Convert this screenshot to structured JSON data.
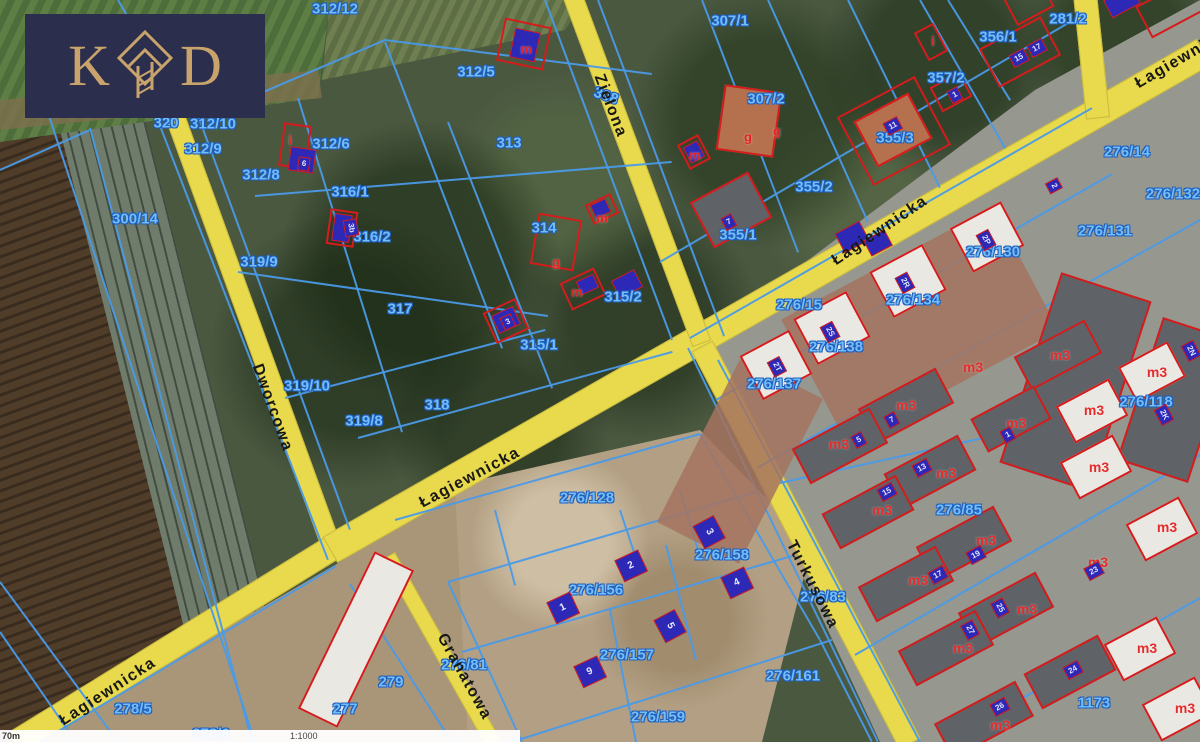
{
  "brand": {
    "letter_left": "K",
    "letter_right": "D",
    "icon": "diamond-house-icon",
    "background_color": "#2b2e4c",
    "gold_color": "#c9a36c"
  },
  "scale_bar": {
    "distance_label": "70m",
    "scale_label": "1:1000"
  },
  "map": {
    "colors": {
      "road_yellow": "#e9d94d",
      "parcel_line_blue": "#4a9ae8",
      "parcel_label_blue": "#74bdf6",
      "building_red": "#d41c1c",
      "building_blue_fill": "#2d28b5"
    },
    "roads": [
      {
        "name": "dworcowa",
        "x1": 172,
        "y1": 108,
        "x2": 332,
        "y2": 548,
        "w": 20
      },
      {
        "name": "lagiewnicka-west",
        "x1": 332,
        "y1": 548,
        "x2": 14,
        "y2": 744,
        "w": 26
      },
      {
        "name": "lagiewnicka-main",
        "x1": 330,
        "y1": 550,
        "x2": 1204,
        "y2": 52,
        "w": 30
      },
      {
        "name": "top-right-stub",
        "x1": 1085,
        "y1": -6,
        "x2": 1098,
        "y2": 118,
        "w": 24
      },
      {
        "name": "zielona",
        "x1": 572,
        "y1": -6,
        "x2": 702,
        "y2": 344,
        "w": 20
      },
      {
        "name": "turkusowa",
        "x1": 702,
        "y1": 346,
        "x2": 910,
        "y2": 744,
        "w": 24
      },
      {
        "name": "granatowa",
        "x1": 388,
        "y1": 556,
        "x2": 494,
        "y2": 744,
        "w": 16
      }
    ],
    "road_labels": [
      [
        "Dworcowa",
        272,
        408,
        70
      ],
      [
        "Łagiewnicka",
        108,
        692,
        -33
      ],
      [
        "Łagiewnicka",
        470,
        478,
        -28
      ],
      [
        "Łagiewnicka",
        880,
        231,
        -34
      ],
      [
        "Łagiewnicka",
        1185,
        57,
        -30
      ],
      [
        "Zielona",
        610,
        106,
        69
      ],
      [
        "Turkusowa",
        812,
        585,
        63
      ],
      [
        "Granatowa",
        464,
        677,
        61
      ]
    ],
    "parcel_labels": [
      [
        "320",
        166,
        123
      ],
      [
        "312/10",
        213,
        124
      ],
      [
        "312/12",
        335,
        9
      ],
      [
        "312/9",
        203,
        149
      ],
      [
        "312/8",
        261,
        175
      ],
      [
        "312/6",
        331,
        144
      ],
      [
        "312/5",
        476,
        72
      ],
      [
        "313",
        509,
        143
      ],
      [
        "307/1",
        730,
        21
      ],
      [
        "307/2",
        766,
        99
      ],
      [
        "281/2",
        1068,
        19
      ],
      [
        "356/1",
        998,
        37
      ],
      [
        "357/2",
        946,
        78
      ],
      [
        "355/3",
        895,
        138
      ],
      [
        "355/2",
        814,
        187
      ],
      [
        "355/1",
        738,
        235
      ],
      [
        "314",
        544,
        228
      ],
      [
        "315/2",
        623,
        297
      ],
      [
        "315/1",
        539,
        345
      ],
      [
        "316/1",
        350,
        192
      ],
      [
        "316/2",
        372,
        237
      ],
      [
        "317",
        400,
        309
      ],
      [
        "318",
        437,
        405
      ],
      [
        "319/9",
        259,
        262
      ],
      [
        "319/10",
        307,
        386
      ],
      [
        "319/8",
        364,
        421
      ],
      [
        "300/14",
        135,
        219
      ],
      [
        "308",
        606,
        96,
        20
      ],
      [
        "276/14",
        1127,
        152
      ],
      [
        "276/132",
        1173,
        194
      ],
      [
        "276/131",
        1105,
        231
      ],
      [
        "276/130",
        993,
        252
      ],
      [
        "276/134",
        913,
        300
      ],
      [
        "276/15",
        799,
        305
      ],
      [
        "276/138",
        836,
        347
      ],
      [
        "276/137",
        774,
        384
      ],
      [
        "276/118",
        1146,
        402
      ],
      [
        "276/85",
        959,
        510
      ],
      [
        "276/128",
        587,
        498
      ],
      [
        "276/156",
        596,
        590
      ],
      [
        "276/158",
        722,
        555
      ],
      [
        "276/157",
        627,
        655
      ],
      [
        "276/159",
        658,
        717
      ],
      [
        "276/161",
        793,
        676
      ],
      [
        "276/83",
        823,
        597
      ],
      [
        "276/81",
        464,
        665
      ],
      [
        "279",
        391,
        682
      ],
      [
        "277",
        345,
        709
      ],
      [
        "278/5",
        133,
        709
      ],
      [
        "278/6",
        211,
        734
      ],
      [
        "1173",
        1094,
        703
      ]
    ],
    "red_labels": [
      [
        "m",
        526,
        49
      ],
      [
        "m",
        695,
        155
      ],
      [
        "g",
        748,
        137
      ],
      [
        "g",
        777,
        131
      ],
      [
        "i",
        933,
        41
      ],
      [
        "i",
        290,
        140
      ],
      [
        "g",
        556,
        262
      ],
      [
        "m",
        602,
        218
      ],
      [
        "m",
        577,
        292
      ]
    ],
    "m3_labels": [
      [
        "m3",
        1060,
        355
      ],
      [
        "m3",
        973,
        367
      ],
      [
        "m3",
        906,
        405
      ],
      [
        "m3",
        839,
        444
      ],
      [
        "m3",
        1094,
        410
      ],
      [
        "m3",
        1157,
        372
      ],
      [
        "m3",
        1016,
        423
      ],
      [
        "m3",
        946,
        473
      ],
      [
        "m3",
        882,
        510
      ],
      [
        "m3",
        1099,
        467
      ],
      [
        "m3",
        1167,
        527
      ],
      [
        "m3",
        986,
        540
      ],
      [
        "m3",
        1098,
        562
      ],
      [
        "m3",
        918,
        580
      ],
      [
        "m3",
        1027,
        609
      ],
      [
        "m3",
        963,
        648
      ],
      [
        "m3",
        1147,
        648
      ],
      [
        "m3",
        1000,
        725
      ],
      [
        "m3",
        1185,
        708
      ]
    ],
    "chips": [
      [
        "6",
        304,
        164,
        8
      ],
      [
        "3b",
        351,
        228,
        80
      ],
      [
        "11",
        893,
        126,
        -28
      ],
      [
        "15",
        1019,
        58,
        -28
      ],
      [
        "17",
        1037,
        48,
        -28
      ],
      [
        "1",
        955,
        95,
        -28
      ],
      [
        "7",
        729,
        222,
        -28
      ],
      [
        "2",
        1054,
        186,
        62
      ],
      [
        "2P",
        986,
        240,
        62
      ],
      [
        "2R",
        905,
        283,
        62
      ],
      [
        "2S",
        830,
        332,
        62
      ],
      [
        "2T",
        777,
        367,
        62
      ],
      [
        "3",
        508,
        322,
        -25
      ],
      [
        "7",
        892,
        420,
        -28
      ],
      [
        "5",
        859,
        440,
        -28
      ],
      [
        "13",
        922,
        468,
        -28
      ],
      [
        "15",
        887,
        492,
        -28
      ],
      [
        "1",
        1008,
        435,
        -28
      ],
      [
        "17",
        938,
        575,
        -28
      ],
      [
        "19",
        976,
        555,
        -28
      ],
      [
        "23",
        1094,
        571,
        -28
      ],
      [
        "25",
        1000,
        608,
        62
      ],
      [
        "27",
        970,
        630,
        62
      ],
      [
        "24",
        1073,
        670,
        -28
      ],
      [
        "26",
        1000,
        707,
        -28
      ],
      [
        "2N",
        1191,
        351,
        62
      ],
      [
        "2K",
        1164,
        415,
        62
      ]
    ],
    "big_chips": [
      [
        "1",
        563,
        608,
        -25
      ],
      [
        "2",
        631,
        566,
        -25
      ],
      [
        "3",
        709,
        532,
        62
      ],
      [
        "4",
        737,
        583,
        -25
      ],
      [
        "5",
        670,
        626,
        62
      ],
      [
        "9",
        590,
        672,
        -25
      ]
    ],
    "boundaries": [
      [
        28,
        52,
        255,
        742
      ],
      [
        90,
        128,
        252,
        742
      ],
      [
        0,
        170,
        90,
        130
      ],
      [
        118,
        0,
        180,
        106
      ],
      [
        0,
        582,
        118,
        742
      ],
      [
        0,
        632,
        76,
        742
      ],
      [
        150,
        100,
        328,
        560
      ],
      [
        196,
        110,
        350,
        530
      ],
      [
        240,
        102,
        385,
        40
      ],
      [
        385,
        40,
        652,
        74
      ],
      [
        255,
        196,
        672,
        162
      ],
      [
        238,
        272,
        548,
        316
      ],
      [
        285,
        398,
        545,
        330
      ],
      [
        358,
        438,
        672,
        352
      ],
      [
        385,
        42,
        502,
        348
      ],
      [
        448,
        122,
        552,
        388
      ],
      [
        298,
        98,
        402,
        432
      ],
      [
        545,
        0,
        672,
        340
      ],
      [
        598,
        0,
        724,
        336
      ],
      [
        702,
        0,
        798,
        252
      ],
      [
        768,
        0,
        868,
        222
      ],
      [
        848,
        0,
        940,
        188
      ],
      [
        920,
        0,
        1005,
        148
      ],
      [
        660,
        262,
        1070,
        22
      ],
      [
        690,
        338,
        1092,
        108
      ],
      [
        948,
        0,
        1010,
        100
      ],
      [
        716,
        400,
        1112,
        174
      ],
      [
        757,
        468,
        1200,
        220
      ],
      [
        780,
        483,
        1200,
        390
      ],
      [
        855,
        655,
        1200,
        455
      ],
      [
        945,
        742,
        1200,
        598
      ],
      [
        718,
        360,
        920,
        742
      ],
      [
        688,
        348,
        878,
        742
      ],
      [
        395,
        520,
        700,
        434
      ],
      [
        448,
        582,
        756,
        492
      ],
      [
        462,
        652,
        792,
        556
      ],
      [
        512,
        742,
        832,
        640
      ],
      [
        448,
        582,
        522,
        742
      ],
      [
        495,
        510,
        515,
        585
      ],
      [
        610,
        610,
        636,
        742
      ],
      [
        666,
        545,
        696,
        660
      ],
      [
        620,
        510,
        638,
        564
      ],
      [
        680,
        490,
        698,
        550
      ],
      [
        700,
        434,
        820,
        640
      ],
      [
        820,
        640,
        872,
        742
      ],
      [
        336,
        566,
        40,
        742
      ],
      [
        350,
        584,
        452,
        742
      ]
    ],
    "buildings": [
      {
        "x": 694,
        "y": 368,
        "w": 92,
        "h": 185,
        "r": 27,
        "t": "brick"
      },
      {
        "x": 800,
        "y": 255,
        "w": 240,
        "h": 140,
        "r": -28,
        "t": "brick"
      },
      {
        "x": 334,
        "y": 552,
        "w": 44,
        "h": 175,
        "r": 26,
        "t": "white"
      },
      {
        "x": 1028,
        "y": 282,
        "w": 95,
        "h": 200,
        "r": 18,
        "t": "roof"
      },
      {
        "x": 1138,
        "y": 325,
        "w": 75,
        "h": 150,
        "r": 18,
        "t": "roof"
      },
      {
        "x": 1018,
        "y": 336,
        "w": 80,
        "h": 38,
        "r": -28,
        "t": "roof"
      },
      {
        "x": 862,
        "y": 386,
        "w": 88,
        "h": 40,
        "r": -28,
        "t": "roof"
      },
      {
        "x": 796,
        "y": 426,
        "w": 88,
        "h": 40,
        "r": -28,
        "t": "roof"
      },
      {
        "x": 975,
        "y": 400,
        "w": 72,
        "h": 38,
        "r": -28,
        "t": "roof"
      },
      {
        "x": 888,
        "y": 452,
        "w": 84,
        "h": 40,
        "r": -28,
        "t": "roof"
      },
      {
        "x": 826,
        "y": 492,
        "w": 84,
        "h": 40,
        "r": -28,
        "t": "roof"
      },
      {
        "x": 920,
        "y": 524,
        "w": 88,
        "h": 40,
        "r": -28,
        "t": "roof"
      },
      {
        "x": 862,
        "y": 564,
        "w": 88,
        "h": 40,
        "r": -28,
        "t": "roof"
      },
      {
        "x": 962,
        "y": 590,
        "w": 88,
        "h": 40,
        "r": -28,
        "t": "roof"
      },
      {
        "x": 902,
        "y": 628,
        "w": 88,
        "h": 40,
        "r": -28,
        "t": "roof"
      },
      {
        "x": 938,
        "y": 700,
        "w": 92,
        "h": 40,
        "r": -28,
        "t": "roof"
      },
      {
        "x": 1028,
        "y": 652,
        "w": 84,
        "h": 40,
        "r": -28,
        "t": "roof"
      },
      {
        "x": 1062,
        "y": 390,
        "w": 60,
        "h": 42,
        "r": -28,
        "t": "white"
      },
      {
        "x": 1066,
        "y": 446,
        "w": 60,
        "h": 42,
        "r": -28,
        "t": "white"
      },
      {
        "x": 1124,
        "y": 352,
        "w": 56,
        "h": 40,
        "r": -28,
        "t": "white"
      },
      {
        "x": 1132,
        "y": 508,
        "w": 60,
        "h": 42,
        "r": -28,
        "t": "white"
      },
      {
        "x": 1110,
        "y": 628,
        "w": 60,
        "h": 42,
        "r": -28,
        "t": "white"
      },
      {
        "x": 1148,
        "y": 688,
        "w": 60,
        "h": 42,
        "r": -28,
        "t": "white"
      },
      {
        "x": 958,
        "y": 212,
        "w": 58,
        "h": 50,
        "r": -28,
        "t": "white"
      },
      {
        "x": 878,
        "y": 255,
        "w": 60,
        "h": 52,
        "r": -28,
        "t": "white"
      },
      {
        "x": 802,
        "y": 302,
        "w": 60,
        "h": 52,
        "r": -28,
        "t": "white"
      },
      {
        "x": 748,
        "y": 340,
        "w": 56,
        "h": 50,
        "r": -28,
        "t": "white"
      },
      {
        "x": 500,
        "y": 22,
        "w": 48,
        "h": 44,
        "r": 12,
        "t": "outline"
      },
      {
        "x": 512,
        "y": 30,
        "w": 26,
        "h": 30,
        "r": 12,
        "t": "blue"
      },
      {
        "x": 682,
        "y": 138,
        "w": 24,
        "h": 28,
        "r": -28,
        "t": "outline"
      },
      {
        "x": 686,
        "y": 143,
        "w": 16,
        "h": 18,
        "r": -28,
        "t": "blue"
      },
      {
        "x": 720,
        "y": 88,
        "w": 58,
        "h": 66,
        "r": 8,
        "t": "orange"
      },
      {
        "x": 920,
        "y": 26,
        "w": 22,
        "h": 32,
        "r": -28,
        "t": "outline"
      },
      {
        "x": 934,
        "y": 78,
        "w": 34,
        "h": 28,
        "r": -28,
        "t": "outline"
      },
      {
        "x": 850,
        "y": 92,
        "w": 88,
        "h": 78,
        "r": -28,
        "t": "outline"
      },
      {
        "x": 862,
        "y": 104,
        "w": 62,
        "h": 52,
        "r": -28,
        "t": "orange"
      },
      {
        "x": 985,
        "y": 30,
        "w": 70,
        "h": 44,
        "r": -28,
        "t": "outline"
      },
      {
        "x": 698,
        "y": 184,
        "w": 66,
        "h": 52,
        "r": -28,
        "t": "roof"
      },
      {
        "x": 281,
        "y": 124,
        "w": 28,
        "h": 44,
        "r": 8,
        "t": "outline"
      },
      {
        "x": 289,
        "y": 148,
        "w": 26,
        "h": 24,
        "r": 8,
        "t": "blue"
      },
      {
        "x": 328,
        "y": 210,
        "w": 28,
        "h": 36,
        "r": 8,
        "t": "outline"
      },
      {
        "x": 333,
        "y": 214,
        "w": 18,
        "h": 28,
        "r": 8,
        "t": "blue"
      },
      {
        "x": 534,
        "y": 216,
        "w": 44,
        "h": 52,
        "r": 10,
        "t": "outline"
      },
      {
        "x": 588,
        "y": 198,
        "w": 28,
        "h": 22,
        "r": -25,
        "t": "outline"
      },
      {
        "x": 592,
        "y": 201,
        "w": 17,
        "h": 15,
        "r": -25,
        "t": "blue"
      },
      {
        "x": 564,
        "y": 274,
        "w": 38,
        "h": 30,
        "r": -25,
        "t": "outline"
      },
      {
        "x": 578,
        "y": 277,
        "w": 19,
        "h": 15,
        "r": -25,
        "t": "blue"
      },
      {
        "x": 488,
        "y": 304,
        "w": 36,
        "h": 34,
        "r": -25,
        "t": "outline"
      },
      {
        "x": 494,
        "y": 310,
        "w": 24,
        "h": 20,
        "r": -25,
        "t": "blue"
      },
      {
        "x": 838,
        "y": 226,
        "w": 28,
        "h": 22,
        "r": -28,
        "t": "blue"
      },
      {
        "x": 866,
        "y": 234,
        "w": 24,
        "h": 18,
        "r": -28,
        "t": "blue"
      },
      {
        "x": 614,
        "y": 274,
        "w": 26,
        "h": 20,
        "r": -28,
        "t": "blue"
      },
      {
        "x": 1106,
        "y": -8,
        "w": 32,
        "h": 20,
        "r": -28,
        "t": "blue"
      },
      {
        "x": 1140,
        "y": -10,
        "w": 62,
        "h": 36,
        "r": -28,
        "t": "outline"
      },
      {
        "x": 1008,
        "y": -12,
        "w": 42,
        "h": 30,
        "r": -28,
        "t": "outline"
      }
    ]
  }
}
